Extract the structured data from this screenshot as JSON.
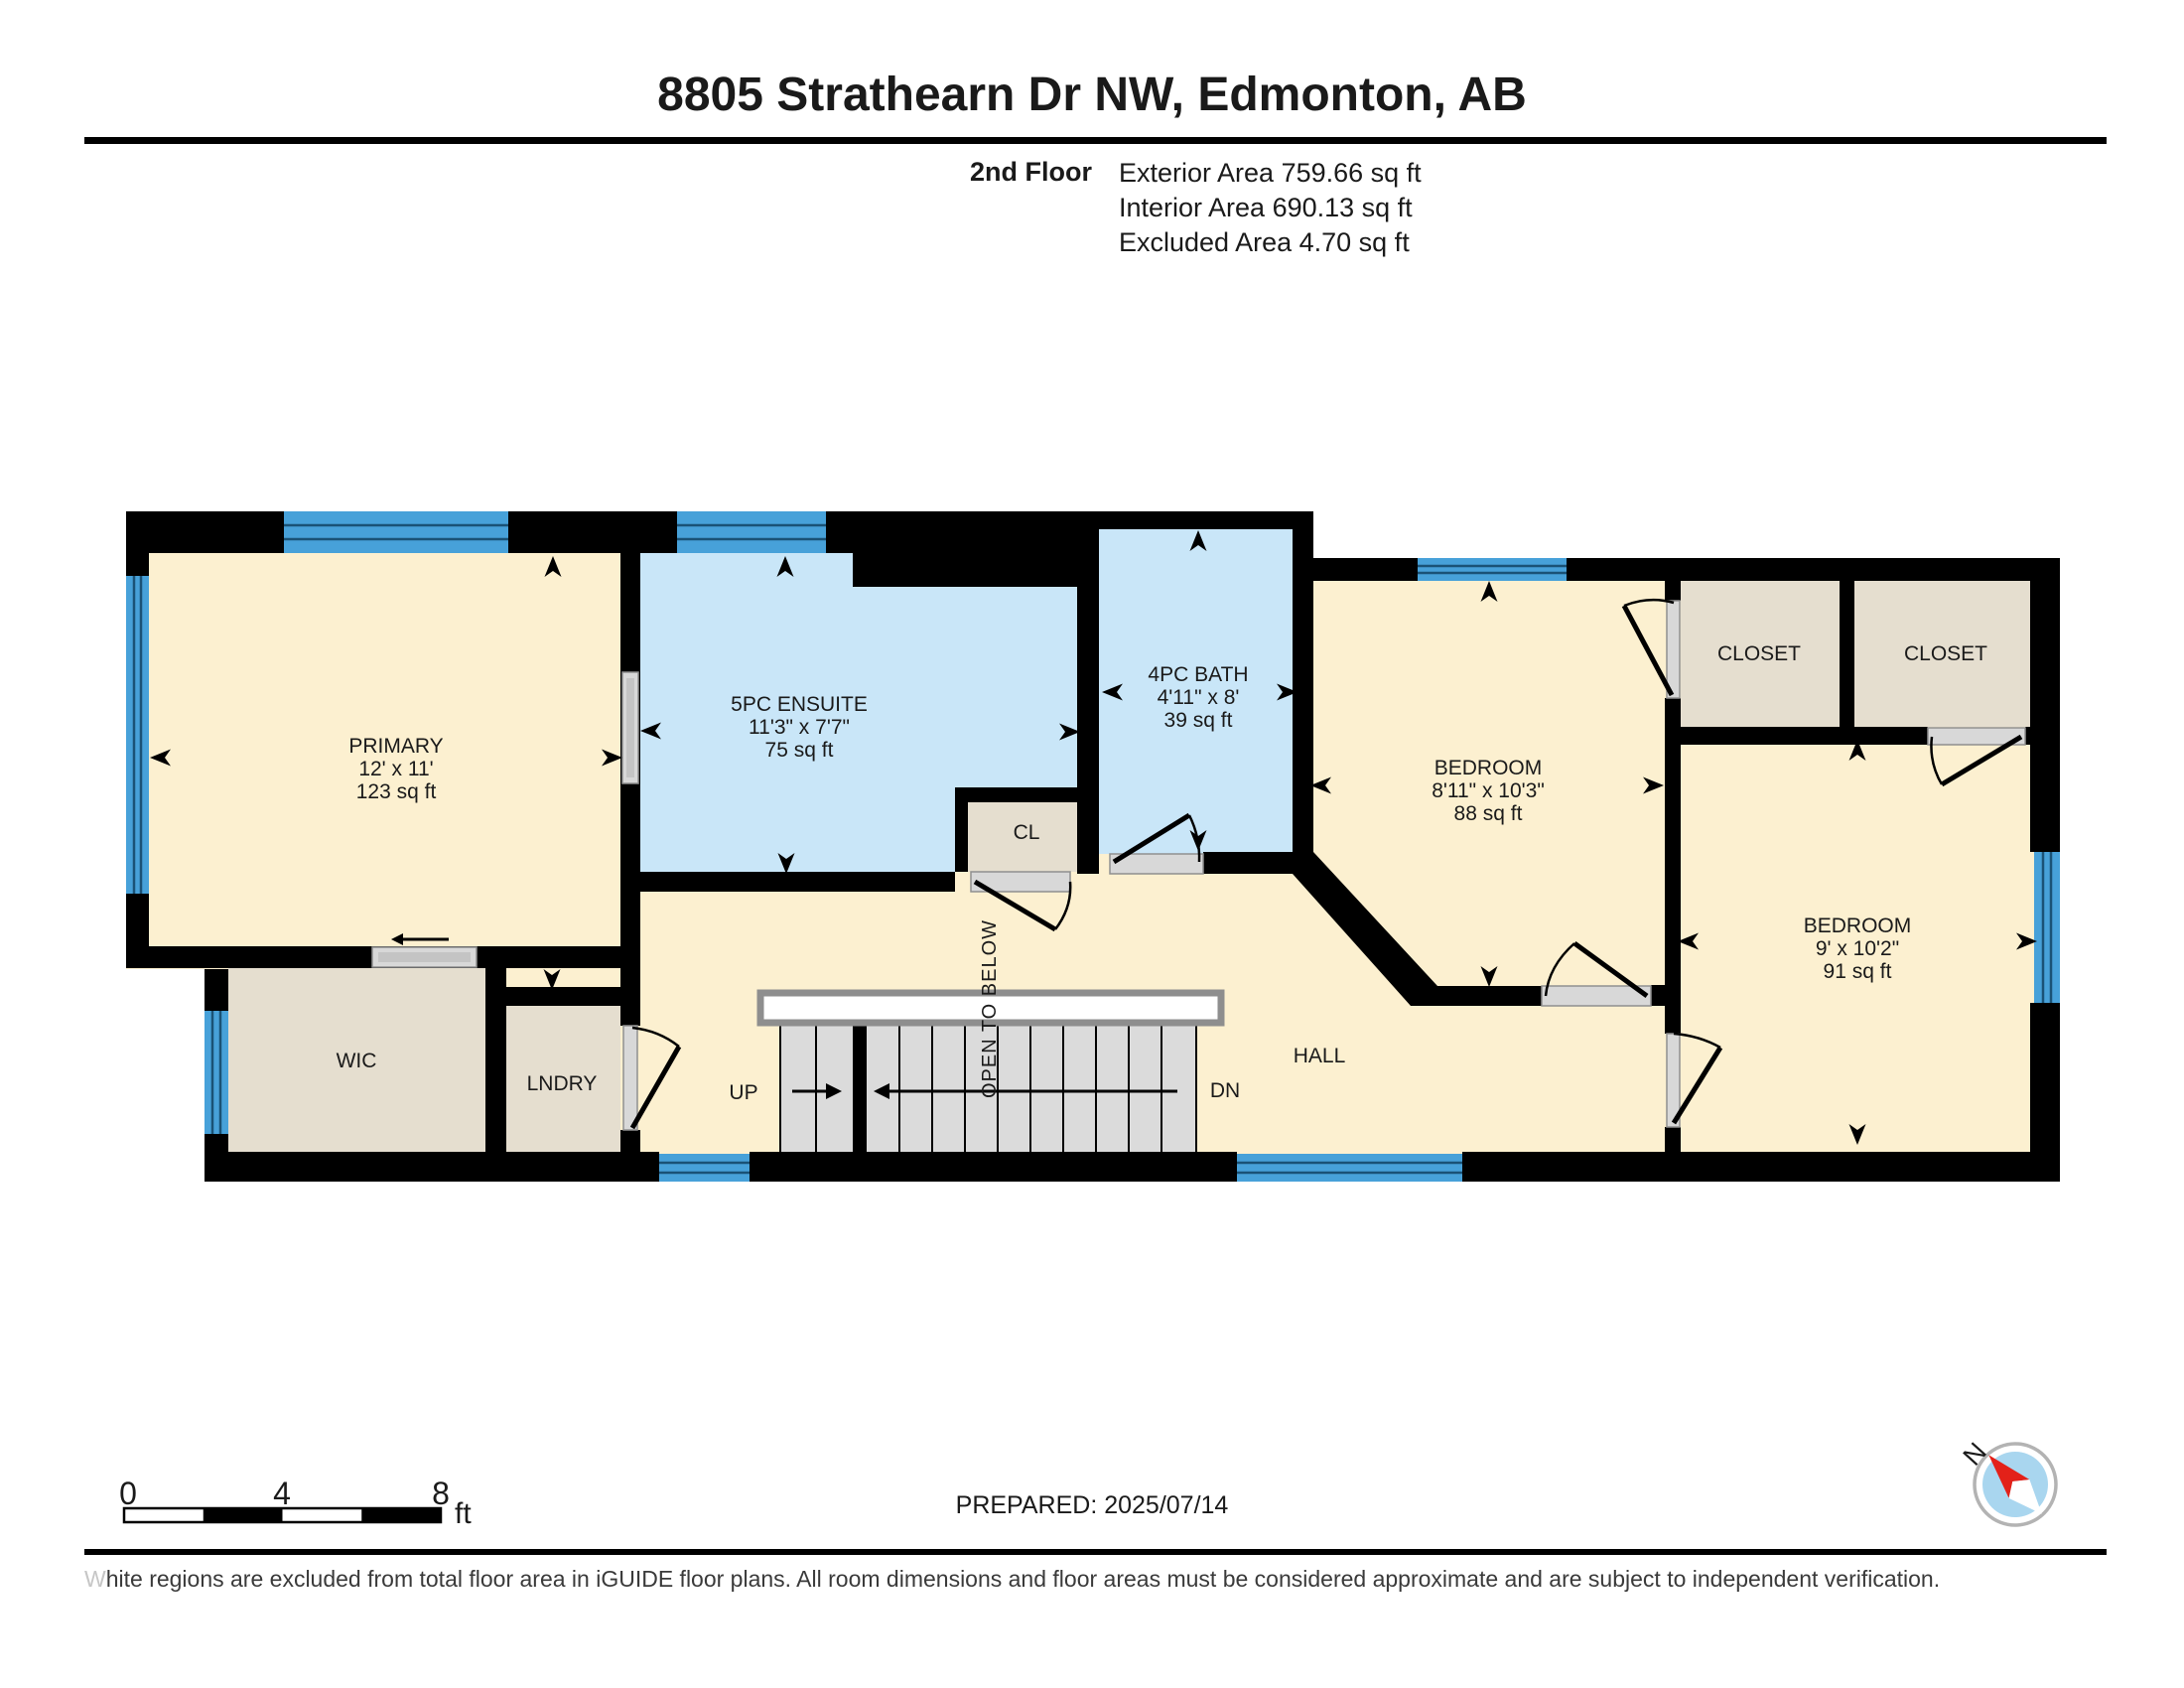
{
  "header": {
    "title": "8805 Strathearn Dr NW, Edmonton, AB",
    "floor_label": "2nd Floor",
    "area_lines": [
      "Exterior Area 759.66 sq ft",
      "Interior Area 690.13 sq ft",
      "Excluded Area 4.70 sq ft"
    ]
  },
  "rooms": {
    "primary": {
      "name": "PRIMARY",
      "dims": "12' x 11'",
      "area": "123 sq ft"
    },
    "ensuite": {
      "name": "5PC ENSUITE",
      "dims": "11'3\" x 7'7\"",
      "area": "75 sq ft"
    },
    "bath": {
      "name": "4PC BATH",
      "dims": "4'11\" x 8'",
      "area": "39 sq ft"
    },
    "bedroom1": {
      "name": "BEDROOM",
      "dims": "8'11\" x 10'3\"",
      "area": "88 sq ft"
    },
    "bedroom2": {
      "name": "BEDROOM",
      "dims": "9' x 10'2\"",
      "area": "91 sq ft"
    },
    "closet1": {
      "name": "CLOSET"
    },
    "closet2": {
      "name": "CLOSET"
    },
    "cl": {
      "name": "CL"
    },
    "wic": {
      "name": "WIC"
    },
    "lndry": {
      "name": "LNDRY"
    },
    "hall": {
      "name": "HALL"
    }
  },
  "stairs": {
    "up": "UP",
    "down": "DN",
    "open_to_below": "OPEN TO BELOW"
  },
  "scale_bar": {
    "ticks": [
      "0",
      "4",
      "8"
    ],
    "unit": "ft"
  },
  "compass": {
    "north_label": "N"
  },
  "footer": {
    "prepared": "PREPARED: 2025/07/14",
    "disclaimer_lead": "W",
    "disclaimer_rest": "hite regions are excluded from total floor area in iGUIDE floor plans. All room dimensions and floor areas must be considered approximate and are subject to independent verification."
  },
  "colors": {
    "wall": "#000000",
    "room_cream": "#fcf0d0",
    "room_blue": "#c9e6f8",
    "room_beige": "#e5decf",
    "window_blue": "#47a1d9",
    "window_line": "#1a5276",
    "stair_gray": "#dbdbdb",
    "door_gray": "#d8d8d8",
    "railing_gray": "#8e8e8e",
    "text": "#1a1a1a",
    "disclaimer": "#3a3a3a",
    "disclaimer_lead": "#c6c6c6",
    "compass_red": "#e32119",
    "compass_blue": "#a9d6ef",
    "compass_ring": "#b3b3b3"
  }
}
